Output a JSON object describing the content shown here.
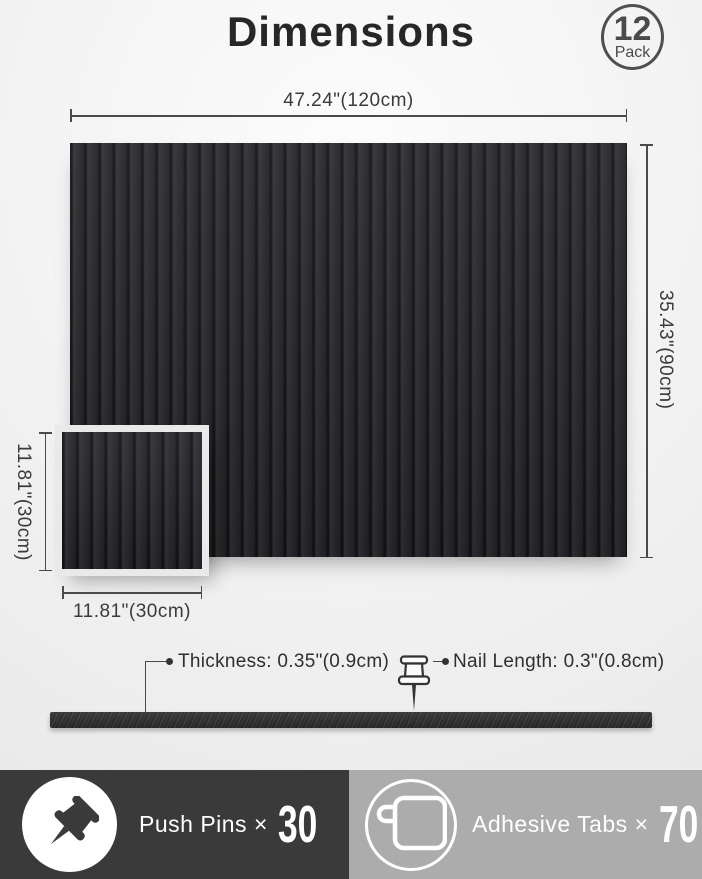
{
  "header": {
    "title": "Dimensions",
    "badge": {
      "count": "12",
      "label": "Pack"
    }
  },
  "dimensions": {
    "large_panel": {
      "width": "47.24\"(120cm)",
      "height": "35.43\"(90cm)"
    },
    "small_panel": {
      "width": "11.81\"(30cm)",
      "height": "11.81\"(30cm)"
    },
    "thickness": "Thickness: 0.35\"(0.9cm)",
    "nail_length": "Nail Length: 0.3\"(0.8cm)"
  },
  "footer": {
    "push_pins": {
      "label": "Push Pins ×",
      "count": "30",
      "icon": "push-pin-icon"
    },
    "adhesive_tabs": {
      "label": "Adhesive Tabs ×",
      "count": "70",
      "icon": "adhesive-tab-icon"
    }
  },
  "colors": {
    "panel": "#28282b",
    "panel_groove": "#151517",
    "footer_dark": "#3a3a3a",
    "footer_gray": "#acacac",
    "dim_line": "#4a4a4a",
    "text": "#333333"
  }
}
